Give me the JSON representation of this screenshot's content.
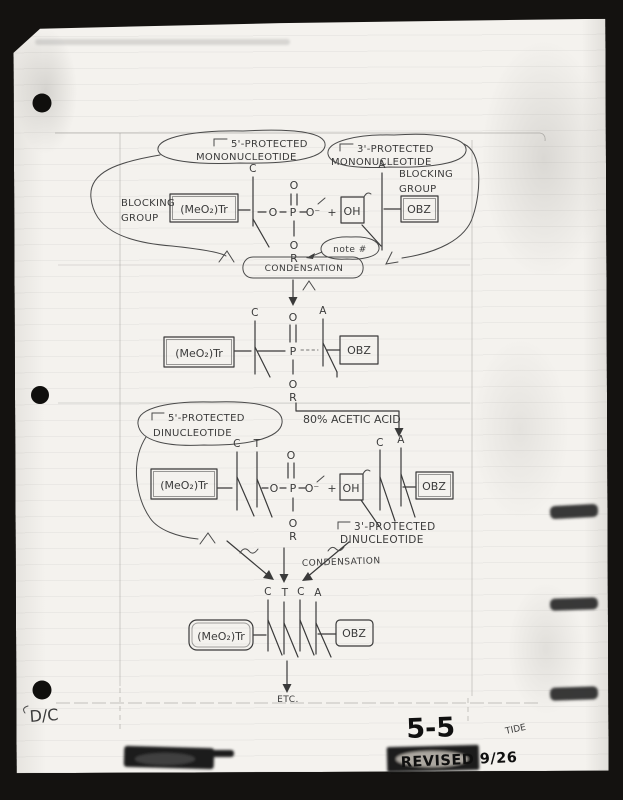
{
  "labels": {
    "mono5": [
      "5'-PROTECTED",
      "MONONUCLEOTIDE"
    ],
    "mono3": [
      "3'-PROTECTED",
      "MONONUCLEOTIDE"
    ],
    "di5": [
      "5'-PROTECTED",
      "DINUCLEOTIDE"
    ],
    "di3": [
      "3'-PROTECTED",
      "DINUCLEOTIDE"
    ],
    "blocking": [
      "BLOCKING",
      "GROUP"
    ],
    "note": "note #",
    "condensation": "CONDENSATION",
    "acetic_acid": "80% ACETIC ACID",
    "etc": "ETC."
  },
  "chem": {
    "tr_group": "(MeO₂)Tr",
    "obz": "OBZ",
    "oh": "OH",
    "base_c": "C",
    "base_t": "T",
    "base_a": "A",
    "o": "O",
    "p": "P",
    "o_minus": "O⁻",
    "r": "R",
    "plus": "+"
  },
  "footer": {
    "initials": "D/C",
    "figure_number": "5-5",
    "revision_note": "REVISED 9/26",
    "side_note": "TIDE"
  },
  "colors": {
    "paper": "#f4f2ee",
    "ink": "#3a3a3a",
    "background": "#141210"
  }
}
